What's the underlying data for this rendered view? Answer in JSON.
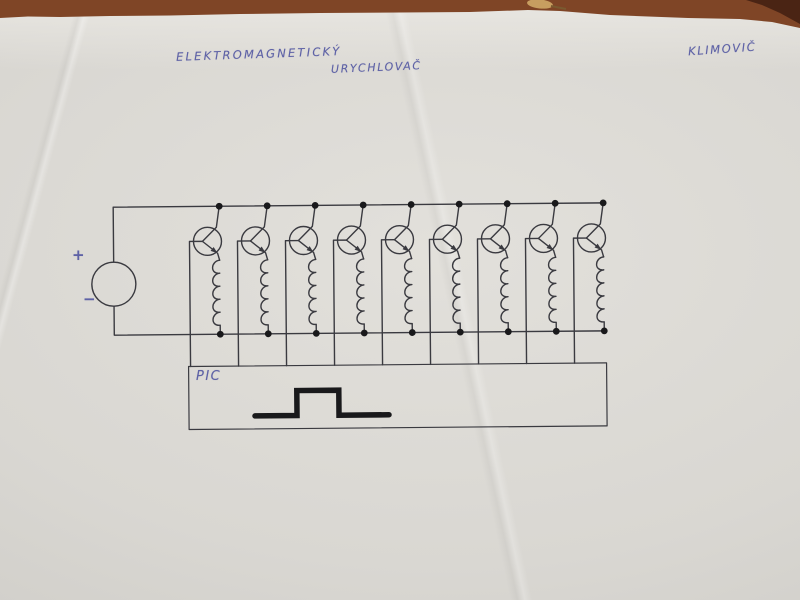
{
  "photo": {
    "paper_color": "#dad8d3",
    "wood_color": "#7f4526",
    "wood_shadow_color": "#3d1c10",
    "wood_chip_color": "#c79e60",
    "ink_color": "#5e62a6",
    "pen_color": "#3a3a40",
    "marker_color": "#19191b"
  },
  "annotations": {
    "title_line1": "ELEKTROMAGNETICKÝ",
    "title_line2": "URYCHLOVAČ",
    "author": "KLIMOVIČ"
  },
  "schematic": {
    "source": {
      "plus_label": "+",
      "minus_label": "−"
    },
    "stages": {
      "count": 9,
      "transistor_type": "npn",
      "load": "coil"
    },
    "controller": {
      "label": "PIC",
      "waveform": "rectangular-pulse"
    }
  }
}
